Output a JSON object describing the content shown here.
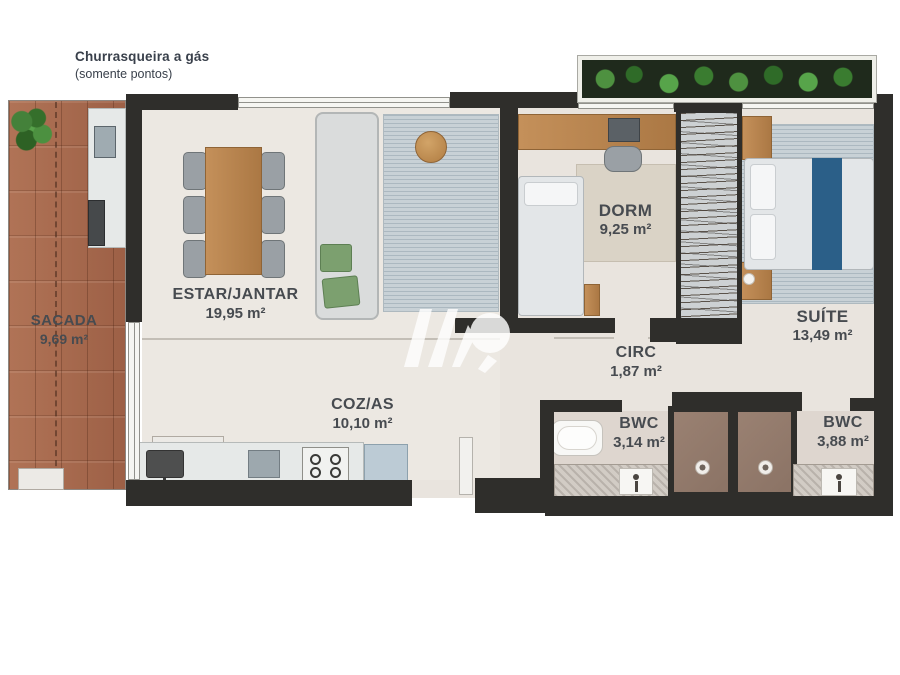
{
  "plan": {
    "annotation": {
      "line1": "Churrasqueira a gás",
      "line2": "(somente pontos)"
    },
    "rooms": [
      {
        "id": "sacada",
        "name": "SACADA",
        "area": "9,69 m²"
      },
      {
        "id": "estar",
        "name": "ESTAR/JANTAR",
        "area": "19,95 m²"
      },
      {
        "id": "dorm",
        "name": "DORM",
        "area": "9,25 m²"
      },
      {
        "id": "suite",
        "name": "SUÍTE",
        "area": "13,49 m²"
      },
      {
        "id": "circ",
        "name": "CIRC",
        "area": "1,87 m²"
      },
      {
        "id": "cozas",
        "name": "COZ/AS",
        "area": "10,10 m²"
      },
      {
        "id": "bwc1",
        "name": "BWC",
        "area": "3,14 m²"
      },
      {
        "id": "bwc2",
        "name": "BWC",
        "area": "3,88 m²"
      }
    ],
    "colors": {
      "wall": "#2f2e2b",
      "floor": "#e9e4de",
      "label": "#474b50",
      "runner": "#2b5f88"
    }
  }
}
